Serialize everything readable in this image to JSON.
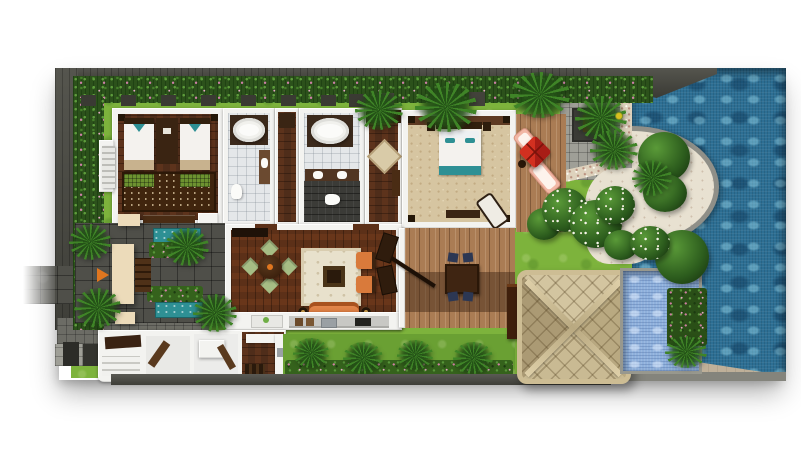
{
  "meta": {
    "kind": "3d-rendered-villa-floor-plan-top-view",
    "visible_text": "none"
  },
  "palette": {
    "wall": "#4a4a44",
    "wall2": "#35352f",
    "grass": "#7db33c",
    "hedge": "#2c511b",
    "pool": "#2d6f94",
    "plunge": "#8eb0dc",
    "teal": "#2e9094",
    "wood": "#4f2d1a",
    "wood2": "#5c3018",
    "deck": "#aa7c54",
    "deck2": "#5e4433",
    "white": "#f3f3f0",
    "tile": "#e4e7e9",
    "tile2": "#3b3b37",
    "stone": "#4f4f49",
    "stone2": "#9f9f97",
    "pebble": "#ded2bd",
    "cream": "#e8e1d1",
    "canopy": "#ecdbba",
    "beige": "#bfb099",
    "orange": "#e0761f",
    "sofa": "#e08449",
    "sage": "#a6bd85",
    "navy": "#2c3753",
    "salmon": "#f1b7a5",
    "umbrella": "#c72722",
    "carpet": "#d6c5a1",
    "rug": "#40250e",
    "ruggreen": "#6d9230",
    "gz_t": "#d3c5a0",
    "gz_r": "#b9a981",
    "gz_b": "#c9ba93",
    "gz_l": "#ab9a74",
    "headboard": "#32200e",
    "flower": "#cc7fa6"
  },
  "regions": [
    "perimeter-wall",
    "tropical-hedge-border",
    "lawn",
    "twin-bedroom",
    "bathroom-1",
    "walk-in-wardrobe-corridor",
    "bathroom-2",
    "dressing-area",
    "master-bedroom",
    "living-dining-room",
    "kitchen-service-wing",
    "entrance-courtyard",
    "water-feature-basins",
    "covered-terrace-deck",
    "sun-lounger-deck",
    "stone-spa-court",
    "flowering-shrubs",
    "gazebo",
    "plunge-pool",
    "green-wall",
    "main-swimming-pool",
    "pool-deck"
  ],
  "counts": {
    "twin_beds": 2,
    "king_beds": 1,
    "bathtubs": 2,
    "sun_loungers": 2,
    "indoor_dining_chairs": 4,
    "outdoor_dining_chairs": 4,
    "umbrellas": 1,
    "water_basins": 2,
    "pools": 2
  }
}
